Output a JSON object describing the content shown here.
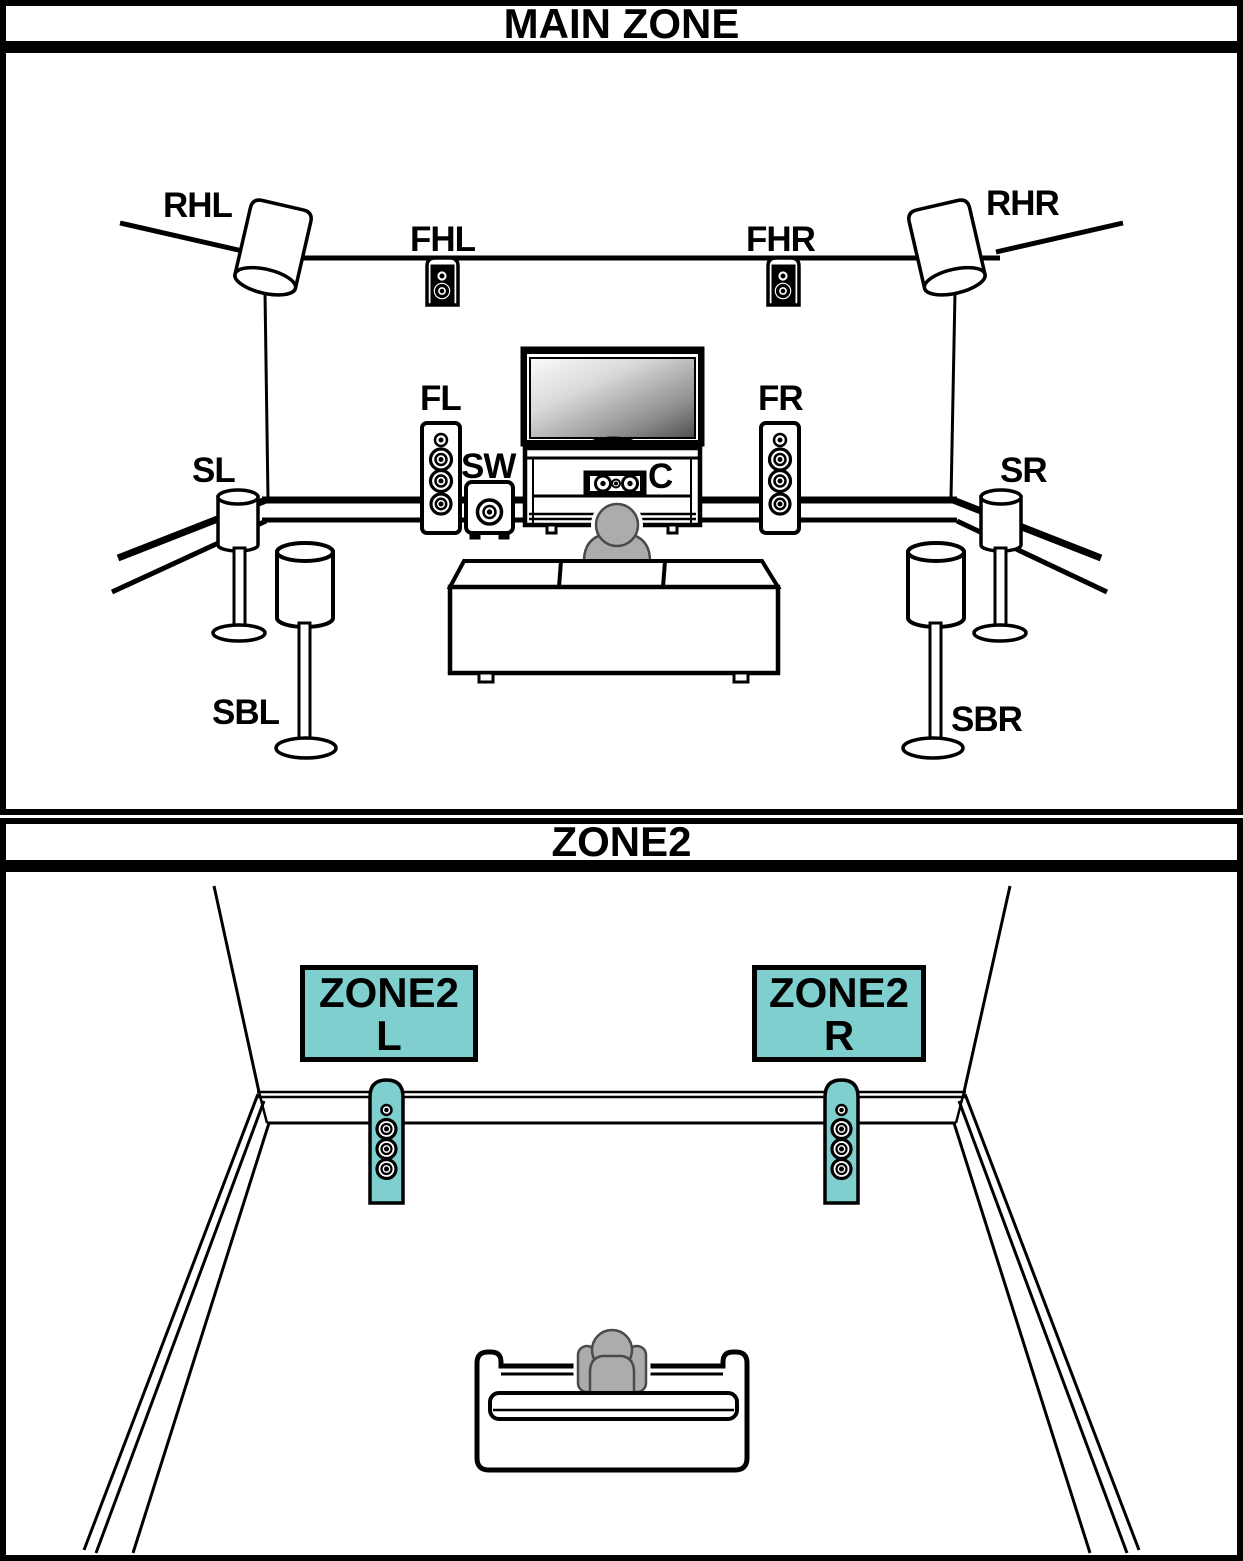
{
  "main_zone": {
    "title": "MAIN ZONE",
    "labels": {
      "rhl": "RHL",
      "fhl": "FHL",
      "fhr": "FHR",
      "rhr": "RHR",
      "fl": "FL",
      "fr": "FR",
      "sw": "SW",
      "c": "C",
      "sl": "SL",
      "sr": "SR",
      "sbl": "SBL",
      "sbr": "SBR"
    }
  },
  "zone2": {
    "title": "ZONE2",
    "left_speaker_tag": {
      "line1": "ZONE2",
      "line2": "L"
    },
    "right_speaker_tag": {
      "line1": "ZONE2",
      "line2": "R"
    }
  },
  "colors": {
    "speaker_highlight_teal": "#7FCFCF",
    "person_gray": "#ACACAC",
    "line_black": "#000000"
  }
}
